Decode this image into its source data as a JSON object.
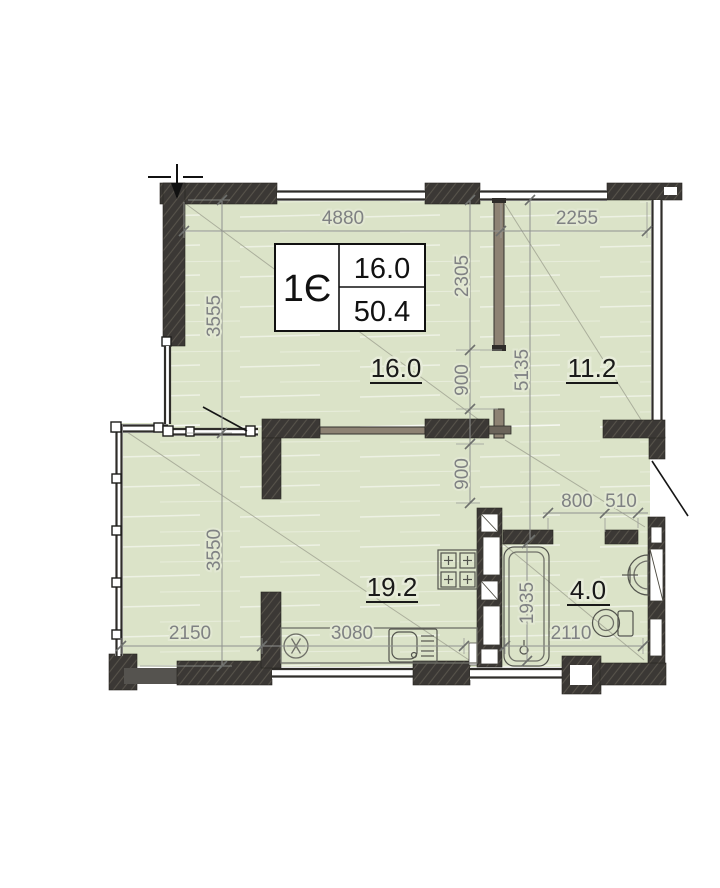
{
  "plan": {
    "title_block": {
      "unit": "1Є",
      "room_area": "16.0",
      "total_area": "50.4"
    },
    "room_labels": {
      "living": "16.0",
      "bedroom": "11.2",
      "kitchen_living": "19.2",
      "bathroom": "4.0"
    },
    "dimensions": {
      "top_main": "4880",
      "top_right": "2255",
      "left_upper": "3555",
      "left_lower": "3550",
      "partition_upper": "2305",
      "opening_upper": "900",
      "opening_lower": "900",
      "right_inner": "5135",
      "bath_door": "800",
      "bath_pier": "510",
      "bath_width": "2110",
      "tub_length": "1935",
      "bottom_left": "2150",
      "kitchen_width": "3080"
    },
    "colors": {
      "floor": "#dbe3c8",
      "wall": "#3b3835",
      "partition": "#8d8273",
      "dim_text": "#7f8183",
      "door_swing": "#161616"
    }
  }
}
